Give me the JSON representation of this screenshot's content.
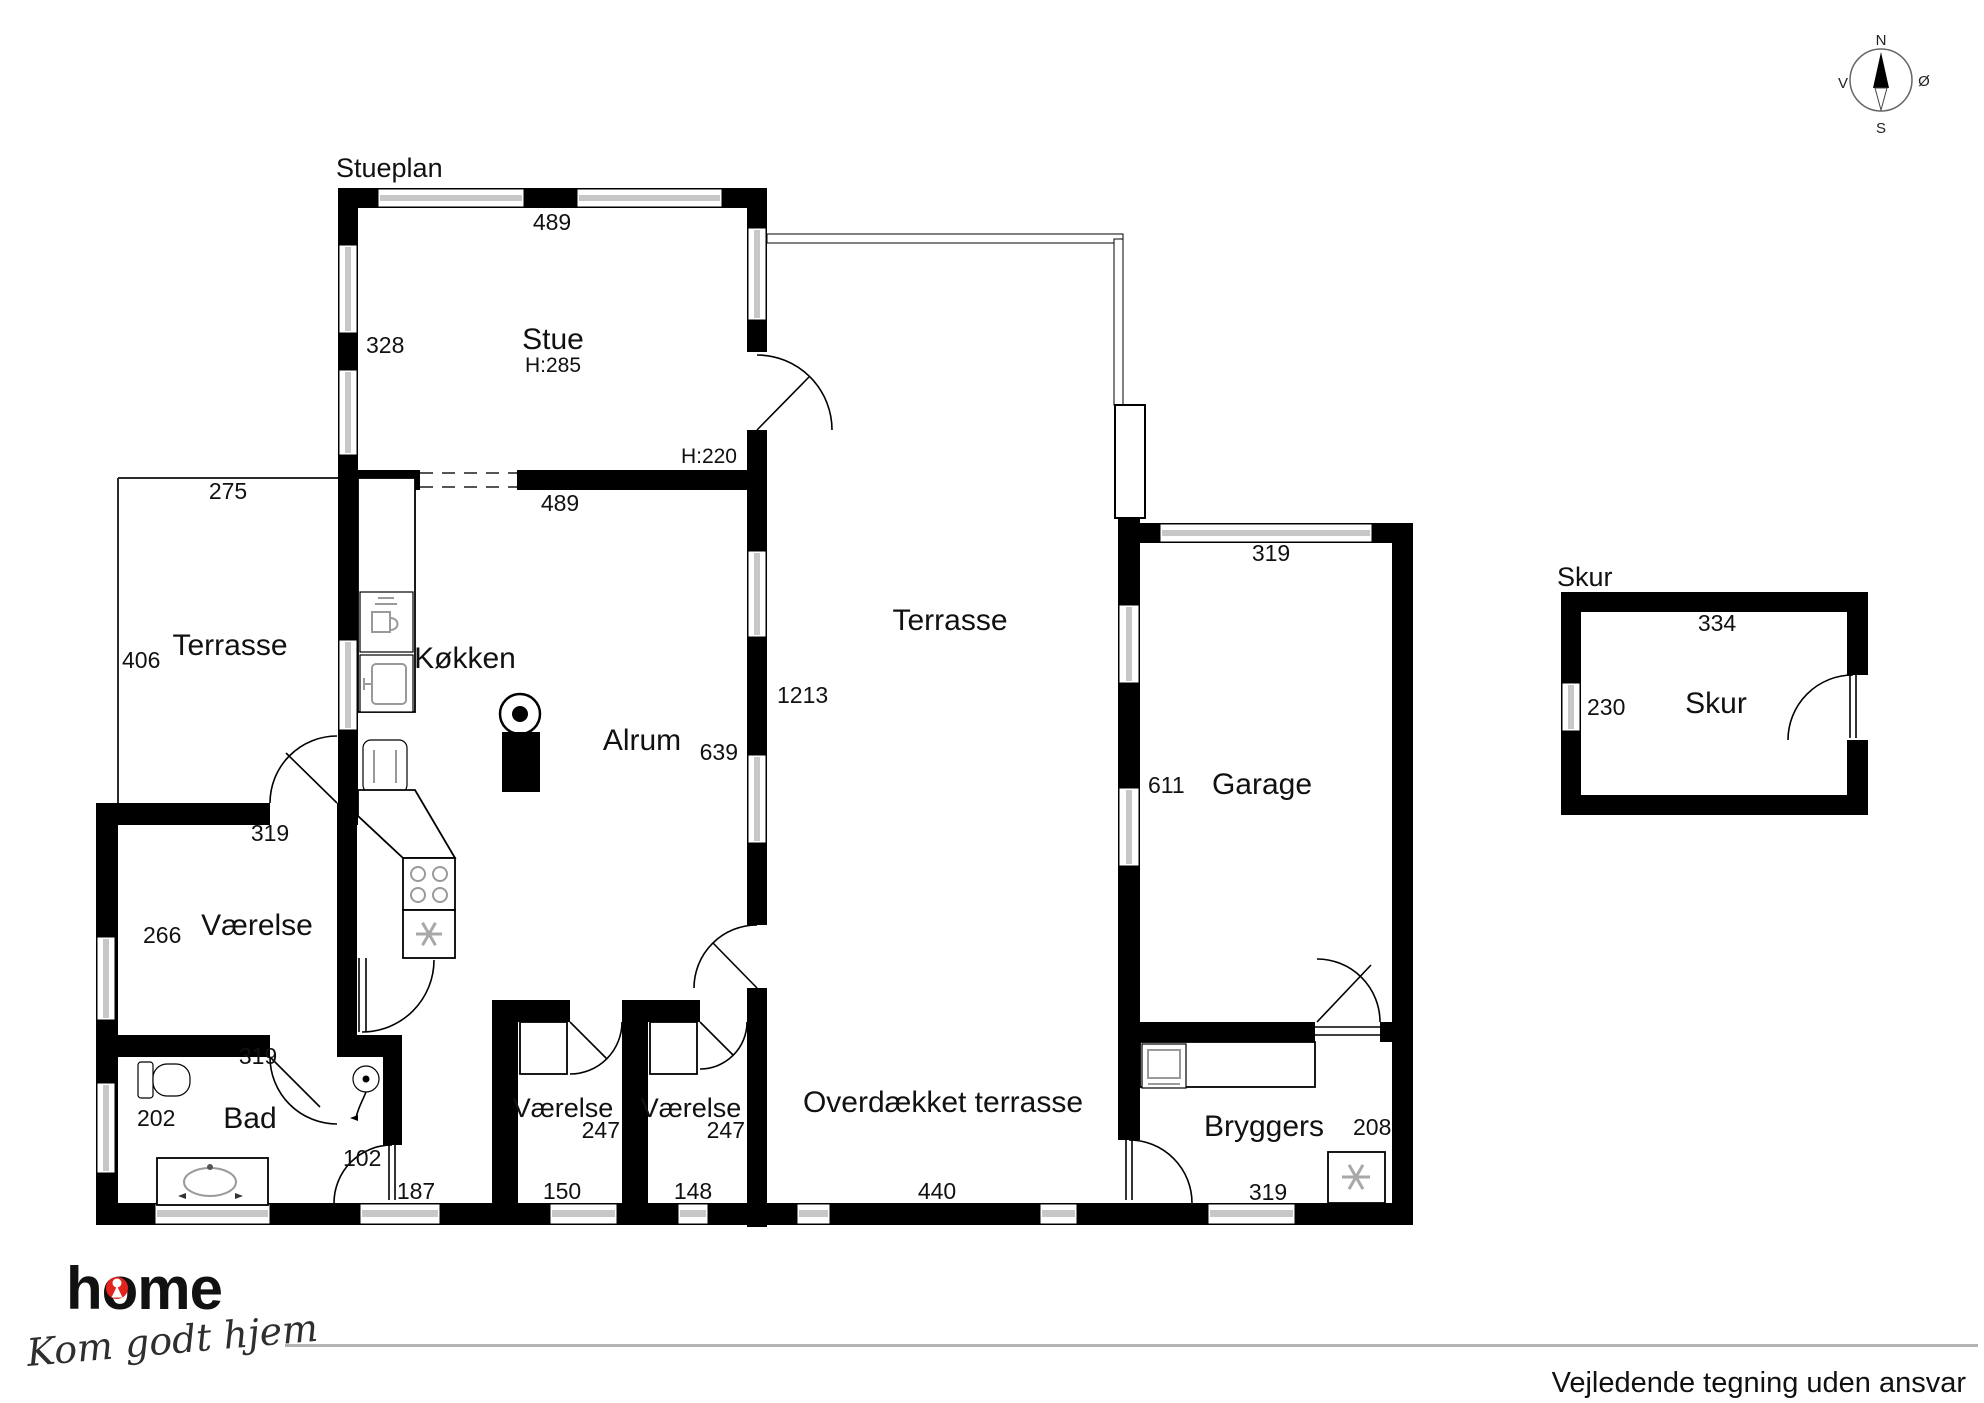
{
  "plan_title": "Stueplan",
  "rooms": {
    "stue": "Stue",
    "stue_height": "H:285",
    "door_height": "H:220",
    "koekken": "Køkken",
    "alrum": "Alrum",
    "terrasse_vest": "Terrasse",
    "terrasse_midt": "Terrasse",
    "vaerelse_vest": "Værelse",
    "bad": "Bad",
    "vaerelse_1": "Værelse",
    "vaerelse_2": "Værelse",
    "overdaekket": "Overdækket terrasse",
    "bryggers": "Bryggers",
    "garage": "Garage",
    "skur_title": "Skur",
    "skur": "Skur"
  },
  "dimensions": {
    "stue_top": "489",
    "stue_left": "328",
    "alrum_top": "489",
    "terrasse_vest_top": "275",
    "terrasse_vest_left": "406",
    "alrum_right": "639",
    "terrasse_midt_right": "1213",
    "vaerelse_vest_top": "319",
    "vaerelse_vest_left": "266",
    "bad_top": "319",
    "bad_left": "202",
    "gang": "102",
    "gang_bund": "187",
    "vaerelse_1_bredde": "247",
    "vaerelse_1_bund": "150",
    "vaerelse_2_bredde": "247",
    "vaerelse_2_bund": "148",
    "overdaekket_bund": "440",
    "garage_top": "319",
    "garage_left": "611",
    "bryggers_hoejre": "208",
    "bryggers_bund": "319",
    "skur_top": "334",
    "skur_left": "230"
  },
  "compass": {
    "north": "N",
    "south": "S",
    "west": "V",
    "east": "Ø"
  },
  "icons": {
    "compass": "compass-rose",
    "stove": "wood-stove-icon",
    "dishwasher": "dishwasher-icon",
    "sink": "kitchen-sink-icon",
    "refrigerator": "refrigerator-icon",
    "cooktop": "cooktop-icon",
    "extractor": "extractor-fan-icon",
    "washer": "washing-machine-icon",
    "heater": "heater-fan-icon",
    "toilet": "toilet-icon",
    "shower": "shower-icon",
    "vanity": "vanity-sink-icon",
    "keyhole": "keyhole-icon"
  },
  "branding": {
    "logo_text": "home",
    "tagline": "Kom godt hjem",
    "logo_color": "#e2241c"
  },
  "footer": {
    "disclaimer": "Vejledende tegning uden ansvar"
  }
}
